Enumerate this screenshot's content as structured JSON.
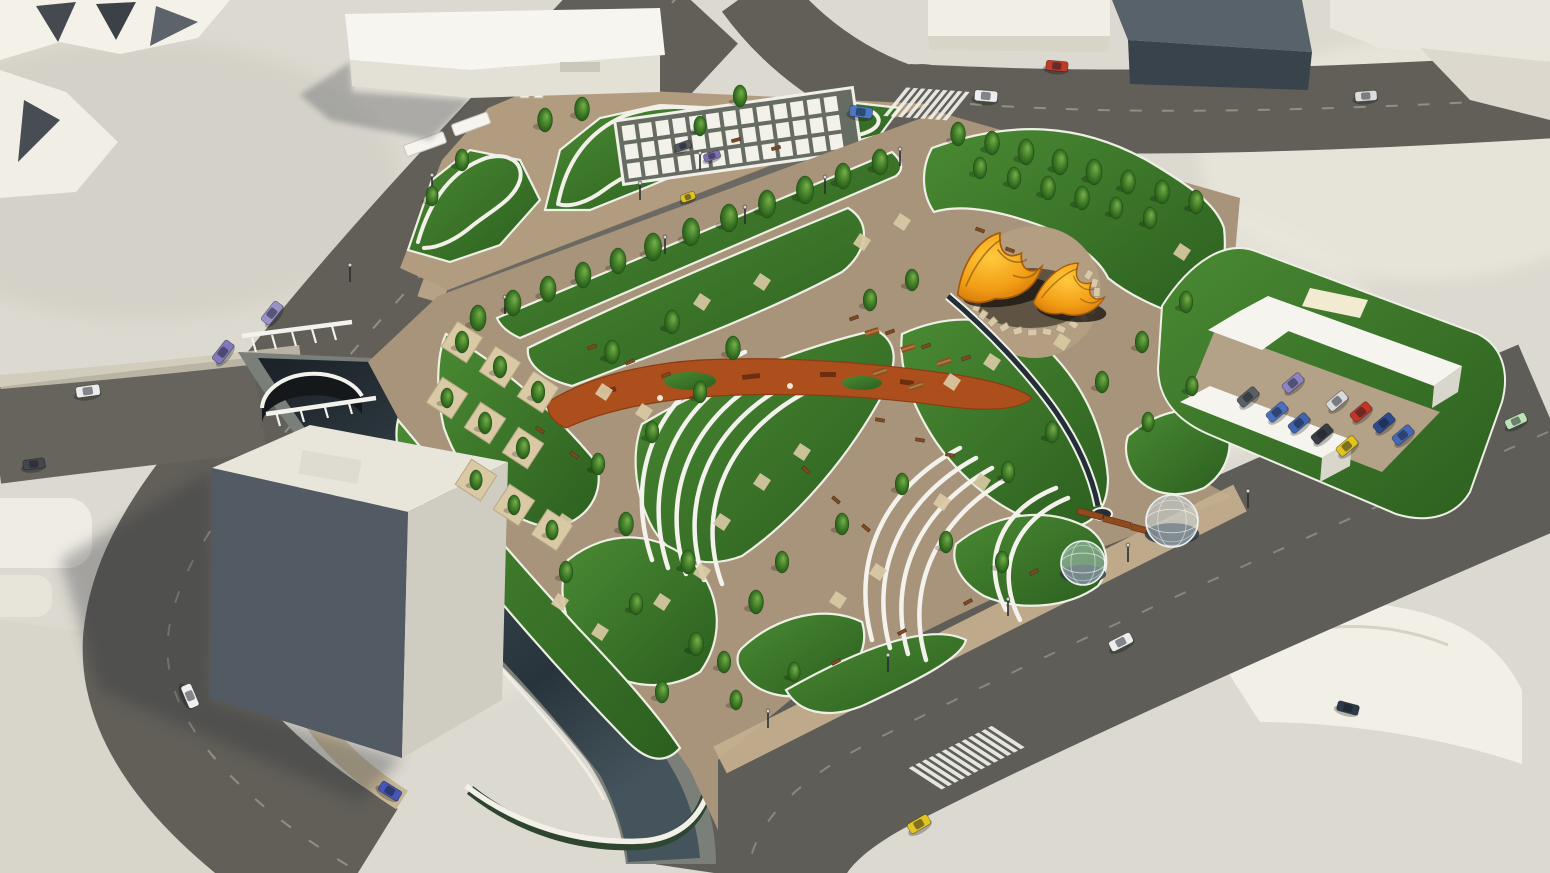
{
  "scene": {
    "kind": "aerial-3d-render",
    "subject": "urban park masterplan with canal, arched bridge, leaf-shaped lawns, tent canopies, glass domes and surrounding streets"
  },
  "palette": {
    "ground": "#dcd9d0",
    "ground_light": "#e9e6dd",
    "road": "#615f58",
    "road_mid": "#6b6962",
    "road_dark": "#5e5d57",
    "park_path": "#a8947a",
    "promenade": "#c3ae8e",
    "lawn": "#3f7c2c",
    "lawn_dark": "#2c5f1f",
    "curb_white": "#eef0e6",
    "canal_water": "#27323b",
    "tent_orange": "#f5a71d",
    "playground_rust": "#ad4f1d",
    "corten": "#8f4a1e",
    "stone": "#d8c9ab",
    "bench": "#7c4a24",
    "tree": "#3e7b26",
    "planter_sand": "#d9c9a4",
    "building_white": "#f4f1e8",
    "building_gray": "#58626b",
    "taxi_yellow": "#e4c41f"
  },
  "legend": {
    "trees": "[x,y,size]",
    "planter_trees": "[x,y,size] tree on sand planter square",
    "paving_squares": "[x,y] small sand picnic pads on lawns",
    "benches": "[x,y,rotation]",
    "picnic_tables": "[x,y,rotation]",
    "lamps": "[x,y] street lights",
    "cars_road": "[x,y,rotation,color,length,width]",
    "cars_parking": "[x,y,color]",
    "tents": "[x,y,scale,rotation] orange canopy structures",
    "domes": "[x,y,radius] glass geodesic pavilions",
    "corten_bars": "[x,y,length,rotation] rust steel ramps",
    "crosswalks": "[x,y,rotation,stripes,stripeLen,skew]"
  },
  "objects": {
    "trees": [
      [
        478,
        318,
        13
      ],
      [
        513,
        303,
        13
      ],
      [
        548,
        289,
        13
      ],
      [
        583,
        275,
        13
      ],
      [
        618,
        261,
        13
      ],
      [
        653,
        247,
        14
      ],
      [
        691,
        232,
        14
      ],
      [
        729,
        218,
        14
      ],
      [
        767,
        204,
        14
      ],
      [
        805,
        190,
        14
      ],
      [
        843,
        176,
        13
      ],
      [
        880,
        162,
        13
      ],
      [
        958,
        134,
        12
      ],
      [
        992,
        143,
        12
      ],
      [
        1026,
        152,
        13
      ],
      [
        1060,
        162,
        13
      ],
      [
        1094,
        172,
        13
      ],
      [
        1128,
        182,
        12
      ],
      [
        1162,
        192,
        12
      ],
      [
        1196,
        202,
        12
      ],
      [
        980,
        168,
        11
      ],
      [
        1014,
        178,
        11
      ],
      [
        1048,
        188,
        12
      ],
      [
        1082,
        198,
        12
      ],
      [
        1116,
        208,
        11
      ],
      [
        1150,
        218,
        11
      ],
      [
        545,
        120,
        12
      ],
      [
        582,
        109,
        12
      ],
      [
        462,
        160,
        11
      ],
      [
        432,
        196,
        10
      ],
      [
        740,
        96,
        11
      ],
      [
        700,
        126,
        10
      ],
      [
        612,
        352,
        12
      ],
      [
        672,
        322,
        12
      ],
      [
        733,
        348,
        12
      ],
      [
        700,
        392,
        11
      ],
      [
        652,
        432,
        11
      ],
      [
        598,
        464,
        11
      ],
      [
        626,
        524,
        12
      ],
      [
        688,
        562,
        12
      ],
      [
        756,
        602,
        12
      ],
      [
        696,
        644,
        12
      ],
      [
        636,
        604,
        11
      ],
      [
        566,
        572,
        11
      ],
      [
        662,
        692,
        11
      ],
      [
        724,
        662,
        11
      ],
      [
        782,
        562,
        11
      ],
      [
        842,
        524,
        11
      ],
      [
        902,
        484,
        11
      ],
      [
        946,
        542,
        11
      ],
      [
        1002,
        562,
        11
      ],
      [
        1052,
        432,
        11
      ],
      [
        1008,
        472,
        11
      ],
      [
        1102,
        382,
        11
      ],
      [
        1142,
        342,
        11
      ],
      [
        1186,
        302,
        11
      ],
      [
        870,
        300,
        11
      ],
      [
        912,
        280,
        11
      ],
      [
        736,
        700,
        10
      ],
      [
        794,
        672,
        10
      ],
      [
        1148,
        422,
        10
      ],
      [
        1192,
        386,
        10
      ]
    ],
    "planter_trees": [
      [
        462,
        342,
        11
      ],
      [
        500,
        367,
        11
      ],
      [
        538,
        392,
        11
      ],
      [
        447,
        398,
        10
      ],
      [
        485,
        423,
        11
      ],
      [
        523,
        448,
        11
      ],
      [
        476,
        480,
        10
      ],
      [
        514,
        505,
        10
      ],
      [
        552,
        530,
        10
      ]
    ],
    "paving_squares": [
      [
        604,
        392
      ],
      [
        644,
        412
      ],
      [
        702,
        302
      ],
      [
        762,
        282
      ],
      [
        862,
        242
      ],
      [
        902,
        222
      ],
      [
        560,
        602
      ],
      [
        600,
        632
      ],
      [
        662,
        602
      ],
      [
        702,
        572
      ],
      [
        952,
        382
      ],
      [
        992,
        362
      ],
      [
        1062,
        342
      ],
      [
        762,
        482
      ],
      [
        802,
        452
      ],
      [
        722,
        522
      ],
      [
        564,
        522
      ],
      [
        1182,
        252
      ],
      [
        982,
        482
      ],
      [
        942,
        502
      ],
      [
        838,
        600
      ],
      [
        878,
        572
      ]
    ],
    "benches": [
      [
        592,
        347,
        -22
      ],
      [
        630,
        362,
        -22
      ],
      [
        666,
        375,
        -22
      ],
      [
        854,
        318,
        -20
      ],
      [
        890,
        332,
        -20
      ],
      [
        926,
        346,
        -20
      ],
      [
        966,
        358,
        -20
      ],
      [
        540,
        430,
        35
      ],
      [
        574,
        455,
        35
      ],
      [
        806,
        470,
        40
      ],
      [
        836,
        500,
        40
      ],
      [
        866,
        528,
        40
      ],
      [
        836,
        662,
        -28
      ],
      [
        902,
        632,
        -28
      ],
      [
        968,
        602,
        -28
      ],
      [
        1034,
        572,
        -28
      ],
      [
        736,
        140,
        -15
      ],
      [
        776,
        148,
        -15
      ],
      [
        980,
        230,
        20
      ],
      [
        1010,
        250,
        20
      ],
      [
        880,
        420,
        10
      ],
      [
        920,
        440,
        10
      ],
      [
        950,
        455,
        10
      ]
    ],
    "picnic_tables": [
      [
        872,
        332,
        -18
      ],
      [
        908,
        348,
        -18
      ],
      [
        944,
        362,
        -18
      ],
      [
        880,
        372,
        -18
      ],
      [
        916,
        386,
        -18
      ]
    ],
    "lamps": [
      [
        505,
        314
      ],
      [
        585,
        284
      ],
      [
        665,
        254
      ],
      [
        745,
        224
      ],
      [
        825,
        194
      ],
      [
        900,
        166
      ],
      [
        350,
        282
      ],
      [
        432,
        192
      ],
      [
        1248,
        508
      ],
      [
        1128,
        562
      ],
      [
        1008,
        616
      ],
      [
        888,
        672
      ],
      [
        768,
        728
      ],
      [
        700,
        170
      ],
      [
        640,
        200
      ]
    ],
    "cars_road": [
      [
        272,
        313,
        -52,
        "#9b91c9",
        24,
        11
      ],
      [
        223,
        352,
        -52,
        "#8279bd",
        24,
        11
      ],
      [
        88,
        391,
        -8,
        "#ececee",
        24,
        11
      ],
      [
        34,
        464,
        -8,
        "#44474e",
        22,
        10
      ],
      [
        190,
        696,
        67,
        "#f0f0ef",
        24,
        11
      ],
      [
        390,
        791,
        32,
        "#4656b5",
        23,
        11
      ],
      [
        861,
        112,
        8,
        "#4a77c4",
        23,
        11
      ],
      [
        986,
        96,
        5,
        "#eceded",
        23,
        11
      ],
      [
        1057,
        66,
        5,
        "#c23b28",
        22,
        10
      ],
      [
        1366,
        96,
        -4,
        "#dddedb",
        22,
        10
      ],
      [
        919,
        824,
        -30,
        "#e4c41f",
        23,
        11
      ],
      [
        1121,
        642,
        -27,
        "#ededec",
        24,
        11
      ],
      [
        1516,
        421,
        -25,
        "#bfe3b8",
        22,
        10
      ],
      [
        1348,
        708,
        15,
        "#2c3a46",
        22,
        10
      ],
      [
        683,
        146,
        -20,
        "#55585f",
        17,
        8
      ],
      [
        712,
        156,
        -20,
        "#7f6fb0",
        17,
        8
      ],
      [
        688,
        197,
        -20,
        "#dfc31d",
        15,
        8
      ]
    ],
    "cars_parking": [
      [
        1293,
        383,
        "#8d84c4"
      ],
      [
        1248,
        397,
        "#5a5e66"
      ],
      [
        1277,
        412,
        "#4a6fbd"
      ],
      [
        1299,
        423,
        "#3f64b0"
      ],
      [
        1322,
        434,
        "#383d44"
      ],
      [
        1347,
        446,
        "#e2c420"
      ],
      [
        1337,
        401,
        "#d9dadd"
      ],
      [
        1361,
        412,
        "#bf3527"
      ],
      [
        1384,
        423,
        "#2e4a8f"
      ],
      [
        1403,
        435,
        "#4668b8"
      ]
    ],
    "parking_rotation": -40,
    "tents": [
      [
        998,
        268,
        1.15,
        -8
      ],
      [
        1070,
        290,
        0.92,
        6
      ]
    ],
    "stone_ring": {
      "cx": 1035,
      "cy": 294,
      "r": 62,
      "squash": 0.62,
      "a0": -30,
      "a1": 215,
      "n": 19
    },
    "domes": [
      [
        1172,
        521,
        26
      ],
      [
        1083,
        563,
        22
      ]
    ],
    "corten_bars": [
      [
        1090,
        514,
        26,
        15
      ],
      [
        1117,
        522,
        28,
        15
      ],
      [
        1144,
        530,
        26,
        15
      ]
    ],
    "crosswalks": [
      [
        928,
        104,
        4,
        9,
        30,
        -35
      ],
      [
        968,
        757,
        -27,
        13,
        34,
        30
      ]
    ]
  }
}
